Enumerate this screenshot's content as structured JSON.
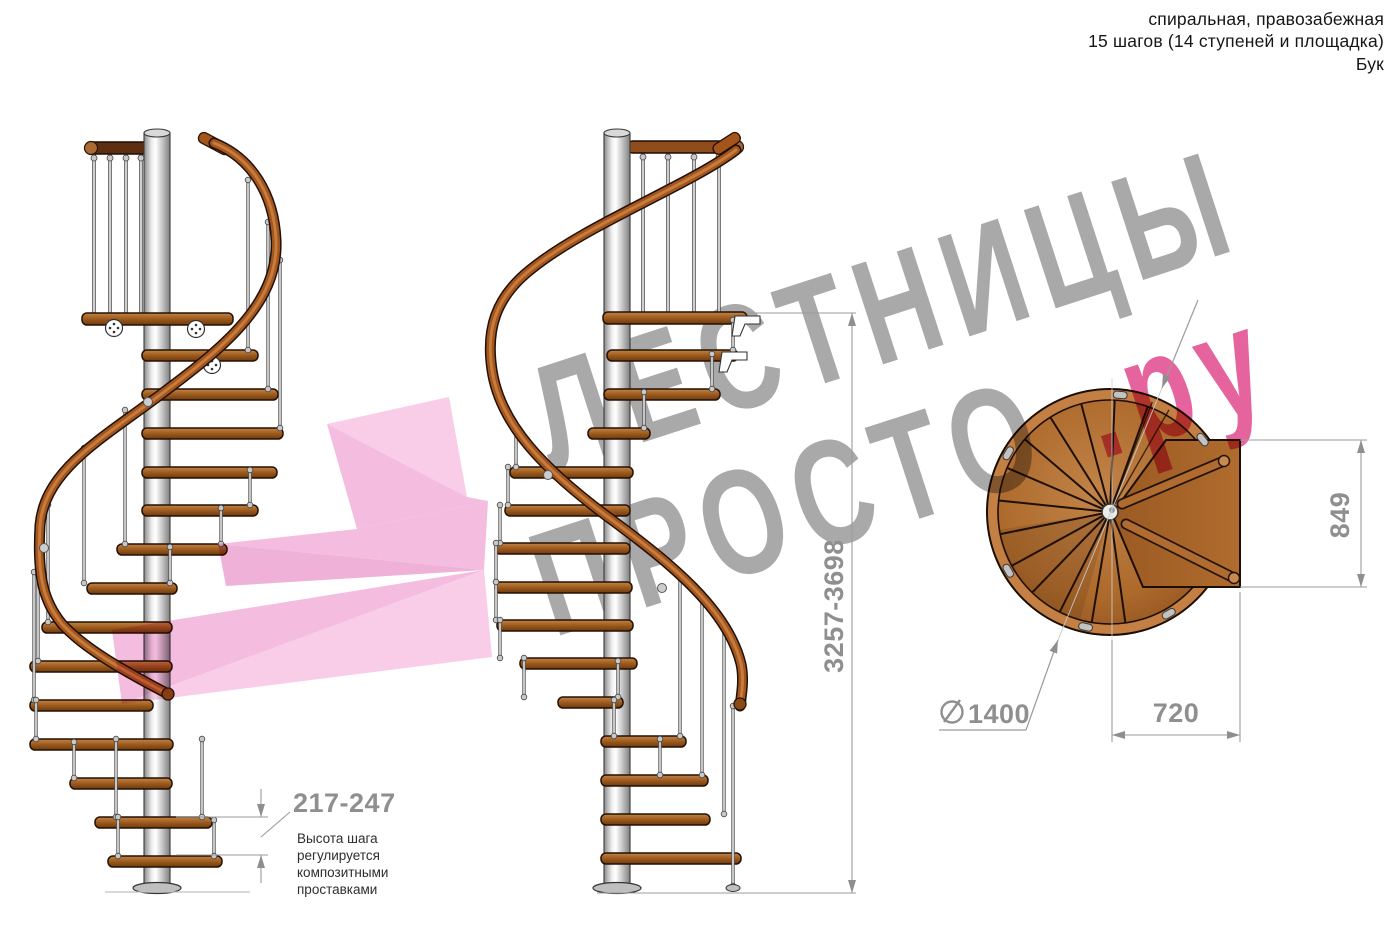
{
  "header": {
    "line1": "спиральная, правозабежная",
    "line2": "15 шагов (14 ступеней и площадка)",
    "line3": "Бук"
  },
  "watermark": {
    "line1": "ЛЕСТНИЦЫ",
    "line2": "ПРОСТО",
    "suffix": ".ру",
    "text_color": "#a9a9a9",
    "accent_color": "#e5649e",
    "arrow_color": "#f3b0da"
  },
  "dimensions": {
    "total_height": "3257-3698",
    "step_height": "217-247",
    "step_height_note": "Высота шага регулируется композитными проставками",
    "diameter": "1400",
    "platform_depth": "849",
    "platform_width": "720"
  }
}
